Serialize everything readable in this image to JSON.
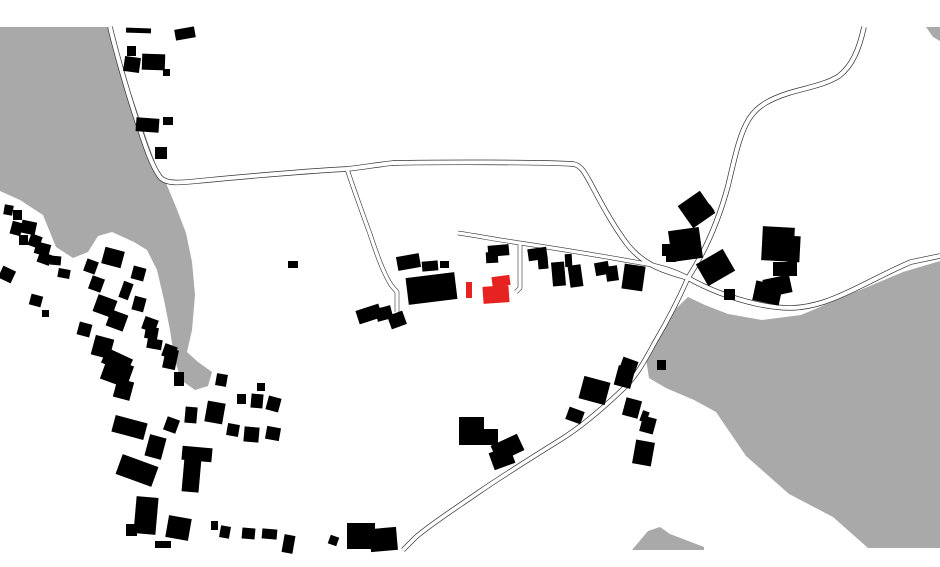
{
  "map": {
    "description": "black-and-white figure-ground site plan with red highlighted building",
    "canvas": {
      "width": 940,
      "height": 567,
      "background": "#ffffff"
    },
    "colors": {
      "area_gray": "#a9a9a9",
      "building": "#000000",
      "highlight_red": "#e62320",
      "road_casing": "#333333",
      "road_surface": "#ffffff"
    },
    "gray_areas": [
      {
        "name": "gray-area-northwest",
        "points": "0,27 110,27 120,62 134,102 147,140 157,168 166,183 176,207 186,233 192,262 195,295 192,330 187,352 198,362 212,372 208,386 195,390 181,380 174,357 170,330 164,300 157,270 147,250 134,242 112,232 98,236 88,252 73,258 56,247 43,215 20,200 0,191"
      },
      {
        "name": "gray-area-lake-east",
        "points": "688,297 705,305 728,314 762,320 801,315 853,293 903,272 940,261 940,548 868,548 833,517 789,494 746,456 716,412 694,400 666,388 649,378 646,359 652,342 666,318"
      },
      {
        "name": "gray-area-bottom-mound",
        "points": "632,550 648,531 660,527 670,534 704,547 704,550"
      },
      {
        "name": "gray-area-topright-wedge",
        "points": "926,27 940,27 940,41 933,37"
      }
    ],
    "roads": [
      {
        "name": "road-northwest-main",
        "d": "M110,27 C116,52 128,95 140,130 C146,148 152,166 160,177 C166,184 178,183 198,181 C230,178 290,172 347,169 C365,167 375,165 393,163 C440,162 540,162 573,164 C581,165 585,173 591,184 C600,201 612,224 627,244 C645,267 668,272 688,278",
        "casing": 5.4,
        "surface": 4.0
      },
      {
        "name": "road-branch-south",
        "d": "M347,169 C354,190 362,212 370,234 C377,255 383,272 391,285 L397,292 L397,312",
        "casing": 4.6,
        "surface": 3.4
      },
      {
        "name": "road-northeast-curve",
        "d": "M864,27 C859,50 852,66 839,76 C825,85 805,88 789,93 C770,99 757,106 749,119 C740,133 735,156 728,186 C719,219 706,250 688,278",
        "casing": 5.4,
        "surface": 4.0
      },
      {
        "name": "road-southwest",
        "d": "M688,278 C677,303 665,325 655,342 C645,360 637,376 622,390 C601,410 581,427 560,440 C531,458 501,477 479,492 C456,508 431,524 416,537 L403,550",
        "casing": 5.0,
        "surface": 3.6
      },
      {
        "name": "road-lakeshore-east",
        "d": "M688,278 C704,287 726,297 757,304 C786,310 802,309 824,302 C851,293 882,274 911,262 L940,256",
        "casing": 5.4,
        "surface": 4.0
      },
      {
        "name": "road-access-center",
        "d": "M458,233 C478,236 499,240 520,243 C560,249 602,256 641,263 C660,266 676,271 688,278",
        "casing": 4.6,
        "surface": 3.4
      },
      {
        "name": "road-access-stub",
        "d": "M520,244 L520,288 L516,292",
        "casing": 4.6,
        "surface": 3.4
      }
    ],
    "buildings": [
      [
        126,
        28,
        25,
        5,
        2
      ],
      [
        175,
        28,
        20,
        11,
        -10
      ],
      [
        127,
        46,
        9,
        10,
        0
      ],
      [
        124,
        57,
        16,
        15,
        8
      ],
      [
        142,
        54,
        23,
        16,
        2
      ],
      [
        163,
        69,
        7,
        7,
        0
      ],
      [
        136,
        118,
        23,
        14,
        4
      ],
      [
        163,
        117,
        10,
        8,
        0
      ],
      [
        155,
        147,
        12,
        12,
        0
      ],
      [
        4,
        205,
        9,
        10,
        10
      ],
      [
        13,
        210,
        9,
        10,
        0
      ],
      [
        11,
        222,
        11,
        13,
        15
      ],
      [
        21,
        221,
        15,
        13,
        12
      ],
      [
        19,
        235,
        9,
        10,
        0
      ],
      [
        29,
        235,
        12,
        12,
        20
      ],
      [
        35,
        243,
        15,
        12,
        15
      ],
      [
        38,
        253,
        13,
        11,
        20
      ],
      [
        50,
        256,
        11,
        9,
        5
      ],
      [
        0,
        268,
        14,
        13,
        25
      ],
      [
        58,
        269,
        12,
        9,
        10
      ],
      [
        30,
        295,
        12,
        11,
        15
      ],
      [
        42,
        310,
        7,
        7,
        0
      ],
      [
        85,
        260,
        12,
        13,
        20
      ],
      [
        90,
        277,
        13,
        14,
        20
      ],
      [
        103,
        249,
        20,
        17,
        15
      ],
      [
        121,
        282,
        10,
        17,
        20
      ],
      [
        132,
        267,
        13,
        13,
        15
      ],
      [
        95,
        297,
        20,
        18,
        20
      ],
      [
        108,
        312,
        18,
        17,
        20
      ],
      [
        133,
        297,
        12,
        14,
        15
      ],
      [
        143,
        318,
        14,
        13,
        20
      ],
      [
        78,
        323,
        13,
        13,
        15
      ],
      [
        93,
        337,
        19,
        20,
        15
      ],
      [
        103,
        353,
        28,
        16,
        25
      ],
      [
        145,
        327,
        13,
        12,
        10
      ],
      [
        163,
        345,
        13,
        13,
        20
      ],
      [
        103,
        361,
        28,
        23,
        20
      ],
      [
        115,
        380,
        17,
        19,
        15
      ],
      [
        147,
        339,
        15,
        10,
        10
      ],
      [
        164,
        349,
        13,
        20,
        12
      ],
      [
        174,
        372,
        10,
        14,
        0
      ],
      [
        216,
        374,
        11,
        12,
        10
      ],
      [
        237,
        394,
        9,
        10,
        0
      ],
      [
        251,
        394,
        12,
        14,
        5
      ],
      [
        257,
        383,
        8,
        8,
        0
      ],
      [
        267,
        397,
        13,
        14,
        15
      ],
      [
        206,
        402,
        18,
        21,
        10
      ],
      [
        185,
        407,
        12,
        16,
        5
      ],
      [
        165,
        418,
        13,
        14,
        20
      ],
      [
        227,
        424,
        12,
        12,
        10
      ],
      [
        244,
        427,
        15,
        15,
        5
      ],
      [
        266,
        427,
        14,
        13,
        10
      ],
      [
        113,
        419,
        33,
        17,
        15
      ],
      [
        147,
        436,
        17,
        22,
        15
      ],
      [
        118,
        460,
        38,
        21,
        20
      ],
      [
        182,
        447,
        30,
        14,
        5
      ],
      [
        183,
        458,
        17,
        34,
        5
      ],
      [
        135,
        497,
        22,
        37,
        5
      ],
      [
        126,
        524,
        11,
        12,
        0
      ],
      [
        155,
        541,
        16,
        7,
        0
      ],
      [
        167,
        517,
        23,
        22,
        10
      ],
      [
        211,
        521,
        7,
        9,
        0
      ],
      [
        220,
        526,
        10,
        12,
        10
      ],
      [
        242,
        528,
        13,
        11,
        5
      ],
      [
        262,
        529,
        15,
        10,
        5
      ],
      [
        283,
        535,
        11,
        18,
        10
      ],
      [
        329,
        536,
        9,
        9,
        20
      ],
      [
        347,
        523,
        28,
        26,
        0
      ],
      [
        370,
        528,
        27,
        23,
        -5
      ],
      [
        288,
        261,
        10,
        7,
        0
      ],
      [
        397,
        255,
        23,
        14,
        -10
      ],
      [
        422,
        261,
        16,
        10,
        -5
      ],
      [
        440,
        261,
        9,
        7,
        0
      ],
      [
        407,
        275,
        49,
        27,
        -7
      ],
      [
        357,
        307,
        24,
        14,
        -18
      ],
      [
        376,
        307,
        16,
        13,
        -15
      ],
      [
        389,
        313,
        16,
        14,
        -20
      ],
      [
        488,
        245,
        21,
        11,
        -5
      ],
      [
        486,
        252,
        12,
        11,
        -3
      ],
      [
        528,
        248,
        19,
        12,
        -8
      ],
      [
        538,
        256,
        10,
        13,
        -5
      ],
      [
        552,
        262,
        13,
        24,
        -5
      ],
      [
        565,
        254,
        7,
        13,
        -3
      ],
      [
        569,
        265,
        13,
        22,
        -8
      ],
      [
        595,
        262,
        14,
        13,
        -10
      ],
      [
        606,
        266,
        12,
        15,
        -8
      ],
      [
        623,
        265,
        21,
        25,
        8
      ],
      [
        683,
        196,
        27,
        27,
        -35
      ],
      [
        705,
        206,
        8,
        8,
        -35
      ],
      [
        670,
        229,
        31,
        31,
        -8
      ],
      [
        662,
        244,
        12,
        12,
        0
      ],
      [
        666,
        254,
        10,
        8,
        0
      ],
      [
        700,
        255,
        31,
        25,
        -30
      ],
      [
        724,
        289,
        11,
        11,
        0
      ],
      [
        657,
        360,
        9,
        10,
        0
      ],
      [
        762,
        227,
        32,
        34,
        3
      ],
      [
        786,
        236,
        14,
        26,
        3
      ],
      [
        773,
        262,
        22,
        14,
        0
      ],
      [
        788,
        261,
        9,
        15,
        0
      ],
      [
        764,
        277,
        27,
        18,
        -12
      ],
      [
        754,
        283,
        27,
        20,
        12
      ],
      [
        621,
        359,
        16,
        12,
        20
      ],
      [
        616,
        367,
        17,
        20,
        15
      ],
      [
        581,
        379,
        27,
        23,
        15
      ],
      [
        567,
        409,
        16,
        13,
        20
      ],
      [
        624,
        399,
        16,
        18,
        15
      ],
      [
        641,
        411,
        7,
        11,
        20
      ],
      [
        641,
        417,
        14,
        16,
        15
      ],
      [
        634,
        441,
        19,
        24,
        10
      ],
      [
        459,
        417,
        25,
        15,
        0
      ],
      [
        459,
        429,
        39,
        16,
        0
      ],
      [
        493,
        439,
        29,
        18,
        -25
      ],
      [
        491,
        449,
        22,
        18,
        -20
      ]
    ],
    "highlighted_buildings": [
      [
        492,
        276,
        18,
        10,
        -8
      ],
      [
        483,
        286,
        26,
        17,
        -4
      ],
      [
        466,
        282,
        6,
        16,
        0
      ]
    ]
  }
}
